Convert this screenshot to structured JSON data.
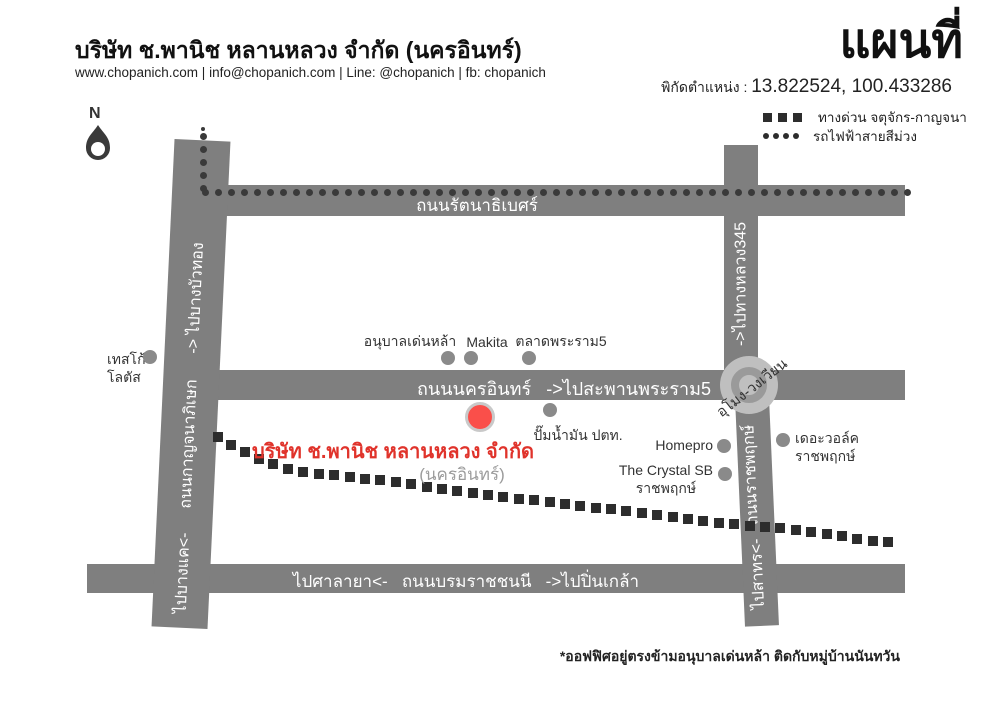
{
  "canvas": {
    "width": 1000,
    "height": 707
  },
  "header": {
    "company": "บริษัท ช.พานิช หลานหลวง จำกัด (นครอินทร์)",
    "contacts": "www.chopanich.com | info@chopanich.com | Line: @chopanich | fb: chopanich"
  },
  "title_block": {
    "title": "แผนที่",
    "coords_label": "พิกัดตำแหน่ง : ",
    "coords_value": "13.822524, 100.433286"
  },
  "legend": {
    "expressway": "ทางด่วน จตุจักร-กาญจนา",
    "metro": "รถไฟฟ้าสายสีม่วง"
  },
  "compass": {
    "label": "N"
  },
  "roads": {
    "rattanathibet": {
      "label": "ถนนรัตนาธิเบศร์"
    },
    "nakhon_in": {
      "label": "ถนนนครอินทร์   ->ไปสะพานพระราม5"
    },
    "borommaratchachonnani": {
      "label": "ไปศาลายา<-   ถนนบรมราชชนนี   ->ไปปิ่นเกล้า"
    },
    "kanchanaphisek": {
      "label_top": "-> ไปบางบัวทอง",
      "label_mid": "ถนนกาญจนาภิเษก",
      "label_bottom": "ไปบางแค<-"
    },
    "highway345": {
      "label": "->ไปทางหลวง345"
    },
    "ratchaphruek": {
      "label_mid": "ถนนราชพฤกษ์",
      "label_bottom": "ไปสาทร<-"
    }
  },
  "roundabout": {
    "label": "อุโมง-วงเวียน"
  },
  "destination": {
    "name": "บริษัท ช.พานิช หลานหลวง จำกัด",
    "branch": "(นครอินทร์)"
  },
  "landmarks": [
    {
      "id": "tesco-lotus",
      "align": "left",
      "x": 107,
      "y": 350,
      "lines": [
        "เทสโก้",
        "โลตัส"
      ],
      "dot": {
        "x": 150,
        "y": 357
      }
    },
    {
      "id": "denla-kindergarten",
      "align": "center",
      "x": 410,
      "y": 332,
      "lines": [
        "อนุบาลเด่นหล้า"
      ],
      "dot": {
        "x": 448,
        "y": 358
      }
    },
    {
      "id": "makita",
      "align": "center",
      "x": 487,
      "y": 333,
      "lines": [
        "Makita"
      ],
      "dot": {
        "x": 471,
        "y": 358
      }
    },
    {
      "id": "talat-phra-ram5",
      "align": "center",
      "x": 561,
      "y": 332,
      "lines": [
        "ตลาดพระราม5"
      ],
      "dot": {
        "x": 529,
        "y": 358
      }
    },
    {
      "id": "ptt-gas-station",
      "align": "center",
      "x": 578,
      "y": 426,
      "lines": [
        "ปั๊มน้ำมัน ปตท."
      ],
      "dot": {
        "x": 550,
        "y": 410
      }
    },
    {
      "id": "homepro",
      "align": "right",
      "x": 713,
      "y": 436,
      "lines": [
        "Homepro"
      ],
      "dot": {
        "x": 724,
        "y": 446
      }
    },
    {
      "id": "the-crystal-sb",
      "align": "right",
      "x": 713,
      "y": 461,
      "text_align": "center",
      "lines": [
        "The Crystal SB",
        "ราชพฤกษ์"
      ],
      "dot": {
        "x": 725,
        "y": 474
      }
    },
    {
      "id": "the-walk-ratchaphruek",
      "align": "left",
      "x": 795,
      "y": 429,
      "lines": [
        "เดอะวอล์ค",
        "ราชพฤกษ์"
      ],
      "dot": {
        "x": 783,
        "y": 440
      }
    }
  ],
  "paths": {
    "metro": {
      "tip": {
        "x": 203,
        "y": 129
      },
      "vertical": {
        "x": 203,
        "y1": 136,
        "y2": 189,
        "step": 13
      },
      "horizontal": {
        "y": 192,
        "x1": 205,
        "x2": 908,
        "step": 13
      }
    },
    "expressway": {
      "dash": 10,
      "spacing": 15.5,
      "points": [
        [
          218,
          437
        ],
        [
          240,
          450
        ],
        [
          262,
          461
        ],
        [
          285,
          468
        ],
        [
          310,
          473
        ],
        [
          340,
          476
        ],
        [
          370,
          479
        ],
        [
          400,
          483
        ],
        [
          430,
          487
        ],
        [
          460,
          491
        ],
        [
          490,
          495
        ],
        [
          520,
          499
        ],
        [
          550,
          502
        ],
        [
          580,
          506
        ],
        [
          610,
          509
        ],
        [
          640,
          513
        ],
        [
          670,
          517
        ],
        [
          700,
          521
        ],
        [
          730,
          524
        ],
        [
          760,
          527
        ],
        [
          790,
          529
        ],
        [
          815,
          532
        ],
        [
          840,
          536
        ],
        [
          865,
          540
        ],
        [
          896,
          543
        ]
      ]
    }
  },
  "footnote": "*ออฟฟิศอยู่ตรงข้ามอนุบาลเด่นหล้า ติดกับหมู่บ้านนันทวัน",
  "colors": {
    "road_gray": "#7f7f7f",
    "roundabout_light": "#bfbfbf",
    "roundabout_ring": "#9a9a9a",
    "landmark_dot": "#8a8a8a",
    "expressway_dash": "#2d2d2d",
    "metro_dot": "#3a3a3a",
    "marker_red": "#fa4f4a",
    "marker_ring": "#c9c9c9",
    "brand_red": "#e0332b",
    "muted_gray": "#9c9c9c"
  }
}
